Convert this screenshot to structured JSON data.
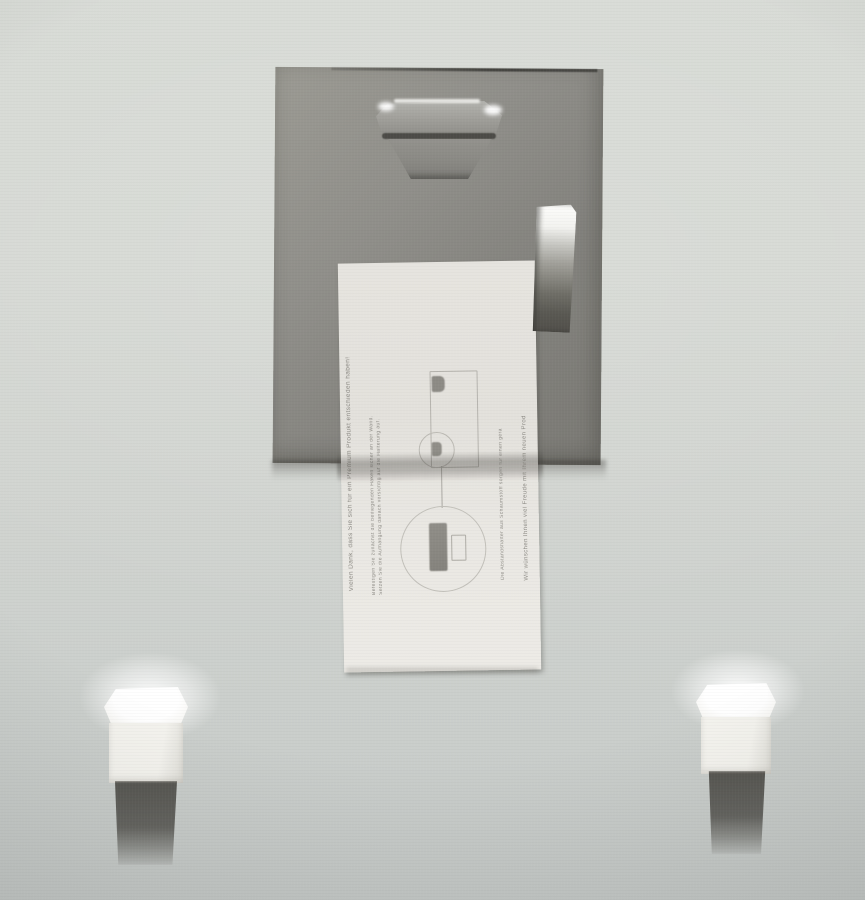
{
  "scene": {
    "kind": "photograph",
    "subject": "Back of a wall-mounted picture frame: grey backing board with metal hanger bracket and shiny metal clip, a hanging instruction card with sideways German fine print, and two white foam spacer blocks on the wall below"
  },
  "colors": {
    "wall_top": "#d8dbd6",
    "wall_bottom": "#c5c9c7",
    "board": "#8d8c87",
    "board_edge_line": "#1a1a18",
    "card": "#e6e4df",
    "card_shadow_band": "rgba(70,68,64,0.38)",
    "metal_highlight": "#f4f4f1",
    "metal_mid": "#9a9994",
    "metal_dark": "#514f4a",
    "foam": "#f4f3ee",
    "foam_shadow": "rgba(58,56,51,0.8)",
    "fine_print": "#7f7d77",
    "diagram_line": "#b6b4ae"
  },
  "card": {
    "note": "fine print runs vertically, reading bottom to top",
    "line_thanks": "Vielen Dank, dass Sie sich für ein Premium Produkt entschieden haben!",
    "line_step1": "Befestigen Sie zunächst die beiliegenden Haken sicher an der Wand.",
    "line_step2": "Setzen Sie die Aufhängung danach vorsichtig auf die Halterung auf.",
    "line_spacers": "Die Abstandshalter aus Schaumstoff sorgen für einen geraden Halt.",
    "line_wishes": "Wir wünschen Ihnen viel Freude mit Ihrem neuen Produkt!"
  },
  "objects": {
    "board": "frame backing board",
    "hanger": "metal hanger bracket",
    "clip": "shiny metal clip",
    "card": "hanging instruction card",
    "foam_left": "left foam spacer block",
    "foam_right": "right foam spacer block"
  }
}
